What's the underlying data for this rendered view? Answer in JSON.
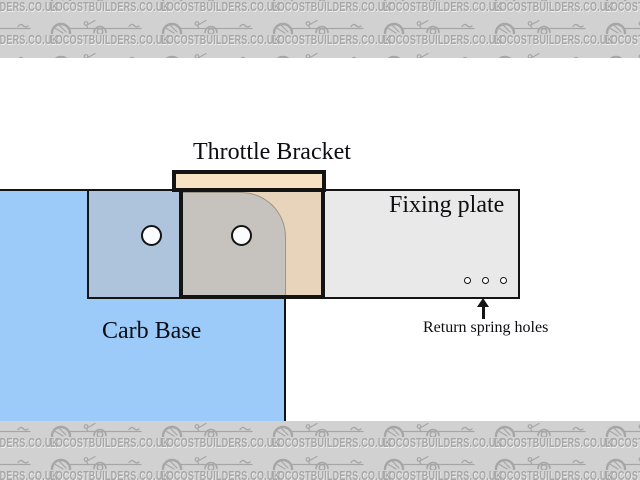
{
  "watermark": {
    "text": "LOCOSTBUILDERS.CO.UK"
  },
  "diagram": {
    "labels": {
      "throttle_bracket": "Throttle Bracket",
      "fixing_plate": "Fixing plate",
      "carb_base": "Carb Base",
      "return_spring_holes": "Return spring holes"
    },
    "parts": {
      "bracket_bolt_holes_count": 2,
      "return_spring_holes_count": 3
    }
  },
  "colors": {
    "page_white": "#ffffff",
    "carb_base_blue": "#9ccbfa",
    "plate_gray": "#e9e9e9",
    "plate_over_base": "#aec3dc",
    "bracket_tan": "#e7d4ba",
    "bracket_over_base": "#c6c2bd",
    "bracket_tab": "#f8e2c4",
    "corner_line": "#9b9488",
    "line_black": "#141414",
    "watermark_bg": "#d1d1d1",
    "watermark_ink": "#a6a6a6"
  }
}
